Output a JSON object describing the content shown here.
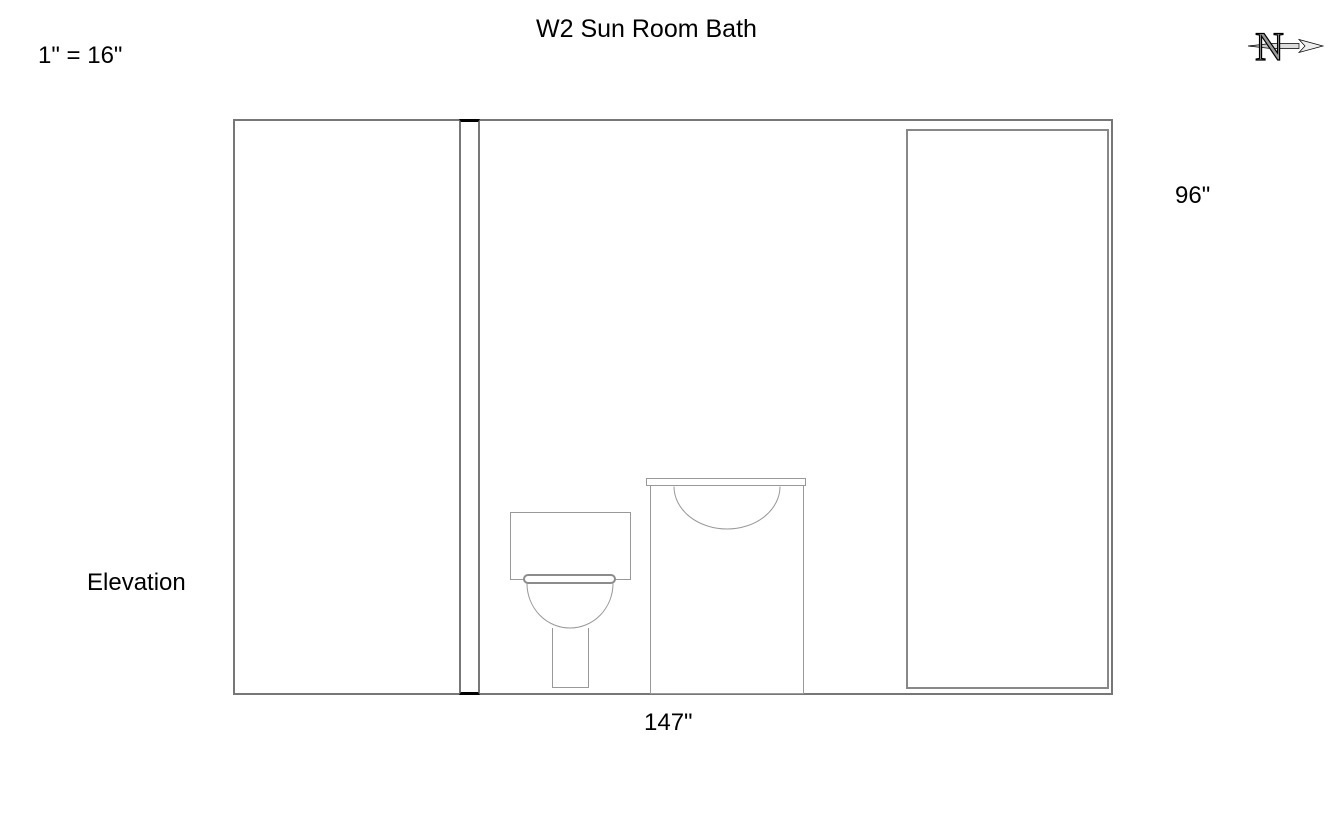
{
  "page": {
    "title": "W2 Sun Room Bath",
    "scale": "1\" = 16\"",
    "view_label": "Elevation"
  },
  "dimensions": {
    "wall_height": "96\"",
    "wall_width": "147\""
  },
  "north_arrow": {
    "letter": "N",
    "direction": "right"
  },
  "colors": {
    "background": "#ffffff",
    "wall_line": "#777777",
    "fixture_line": "#999999",
    "section_cap": "#000000",
    "text": "#000000"
  },
  "drawing": {
    "objects": [
      {
        "name": "room-outline",
        "kind": "wall-elevation"
      },
      {
        "name": "wall-section-strip",
        "kind": "wall-section"
      },
      {
        "name": "door-panel",
        "kind": "panel"
      },
      {
        "name": "toilet",
        "kind": "fixture"
      },
      {
        "name": "vanity-sink",
        "kind": "fixture"
      }
    ]
  }
}
